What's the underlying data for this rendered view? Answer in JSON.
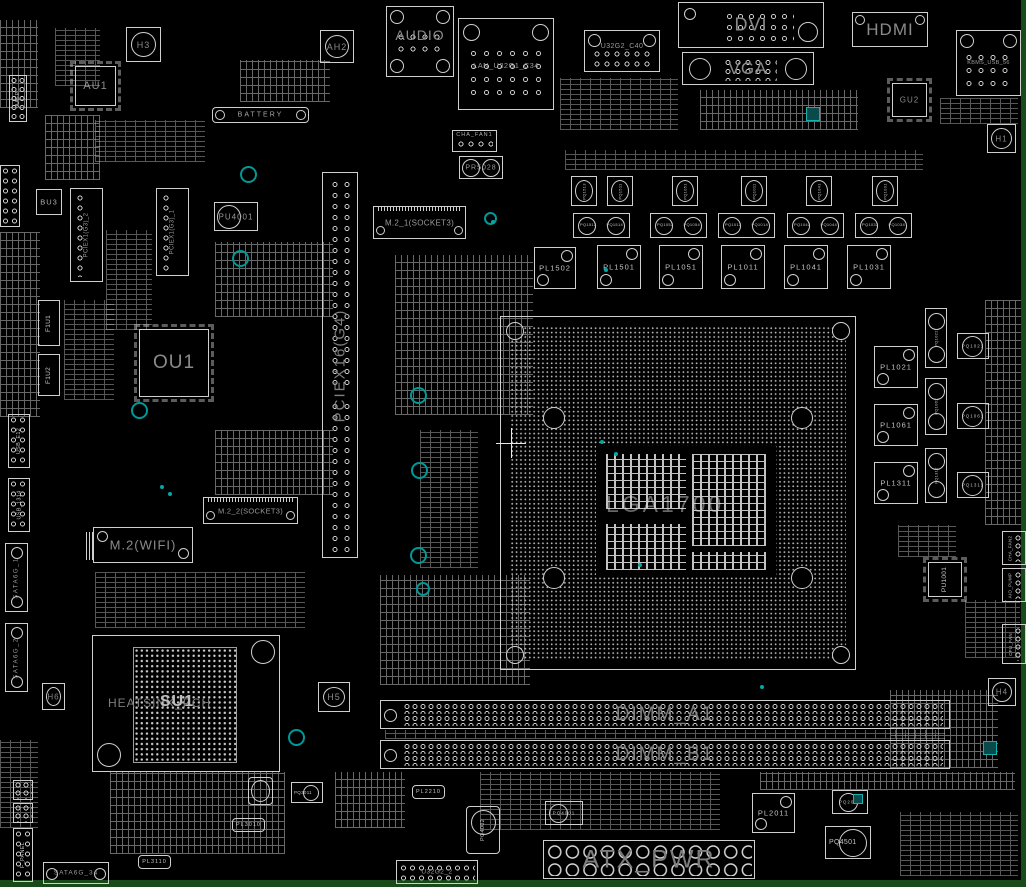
{
  "colors": {
    "board": "#000000",
    "margin": "#1a4a1a",
    "silkscreen": "#cfcfcf",
    "big_label": "#8a8a8a",
    "small_label": "#c4c4c4",
    "accent_teal": "#009898"
  },
  "rear_io": {
    "audio": "AUDIO",
    "lan_usb": "LAN_U32G1_C34",
    "usb_c": "U32G2_C40",
    "dvi": "DVI",
    "vga": "VGA",
    "hdmi": "HDMI",
    "kbms_usb": "KBMS_USB_56"
  },
  "headers": {
    "aafp": "AAFP",
    "battery": "BATTERY",
    "cha_fan1": "CHA_FAN1",
    "cha_fan2": "CHA_FAN2",
    "aio_pump": "AIO_PUMP",
    "cpu_fan": "CPU_FAN",
    "f_panel": "F_PANEL",
    "usb_e12": "USB_E12",
    "usb_1314": "USB_1314",
    "usb3_front": "U32G2_2",
    "atx_power": "ATX_PWR",
    "sata1": "SATA6G_1",
    "sata2": "SATA6G_2",
    "sata34": "SATA6G_34"
  },
  "slots": {
    "pciex16": "PCIEX16(G4)",
    "pciex1_1": "PCIEX1(G3)_1",
    "pciex1_2": "PCIEX1(G3)_2",
    "m2_1": "M.2_1(SOCKET3)",
    "m2_2": "M.2_2(SOCKET3)",
    "m2_wifi": "M.2(WIFI)",
    "dimm_a1": "DIMM_A1",
    "dimm_b1": "DIMM_B1"
  },
  "cpu": {
    "socket": "LGA1700"
  },
  "pch": {
    "heatsink": "HEATSINK_PCH",
    "chip": "SU1"
  },
  "chips": {
    "au1": "AU1",
    "bu3": "BU3",
    "ou1": "OU1",
    "gu2": "GU2",
    "pu4001": "PU4001",
    "pu1001": "PU1001",
    "pr5028": "PR5028",
    "f1u1": "F1U1",
    "f1u2": "F1U2"
  },
  "vrm": {
    "inductors_top": [
      "PL1502",
      "PL1501",
      "PL1051",
      "PL1011",
      "PL1041",
      "PL1031"
    ],
    "inductors_right": [
      "PL1021",
      "PL1061",
      "PL1311"
    ],
    "fets_top": [
      "PQ1513",
      "PQ1511",
      "PQ1051",
      "PQ1011",
      "PQ1041",
      "PQ1031"
    ],
    "fet_pairs_top": [
      [
        "PQ1512",
        "PQ1514"
      ],
      [
        "PQ1052",
        "PQ1054"
      ],
      [
        "PQ1012",
        "PQ1014"
      ],
      [
        "PQ1042",
        "PQ1044"
      ],
      [
        "PQ1032",
        "PQ1034"
      ]
    ],
    "fets_right": [
      "PQ1021",
      "PQ1061",
      "PQ1311"
    ],
    "fet_pairs_right": [
      [
        "PQ1022",
        "PQ1024"
      ],
      [
        "PQ1062",
        "PQ1064"
      ],
      [
        "PQ1312",
        "PQ1314"
      ]
    ]
  },
  "power_parts": {
    "pl2011": "PL2011",
    "pq4501": "PQ4501",
    "pq4001": "PQ4001",
    "pq4002": "PQ4002",
    "pq3011": "PQ3011",
    "pq2011": "PQ2011",
    "pl2210": "PL2210",
    "pl3010": "PL3010",
    "pl3110": "PL3110"
  },
  "holes": {
    "h1": "H1",
    "ah2": "AH2",
    "h3": "H3",
    "h4": "H4",
    "h5": "H5",
    "h6": "H6"
  }
}
